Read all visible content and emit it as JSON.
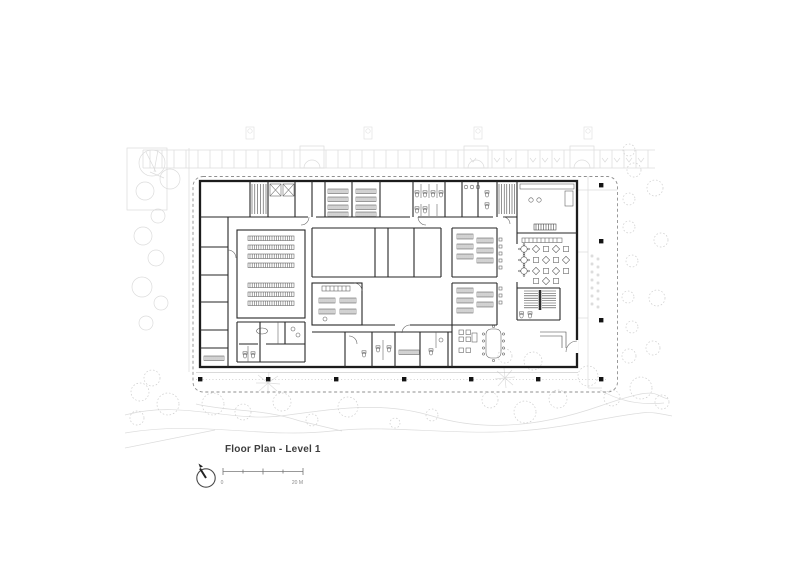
{
  "figure": {
    "title": "Floor Plan - Level 1",
    "scale_bar": {
      "start_label": "0",
      "end_label": "20 M",
      "segments": 4
    },
    "north_arrow": "north-arrow",
    "colors": {
      "background": "#ffffff",
      "walls": "#1c1c1c",
      "context_linework": "#dcdcdc",
      "boundary_dashed": "#8f8f8f",
      "title_text": "#3d3d3d"
    }
  }
}
